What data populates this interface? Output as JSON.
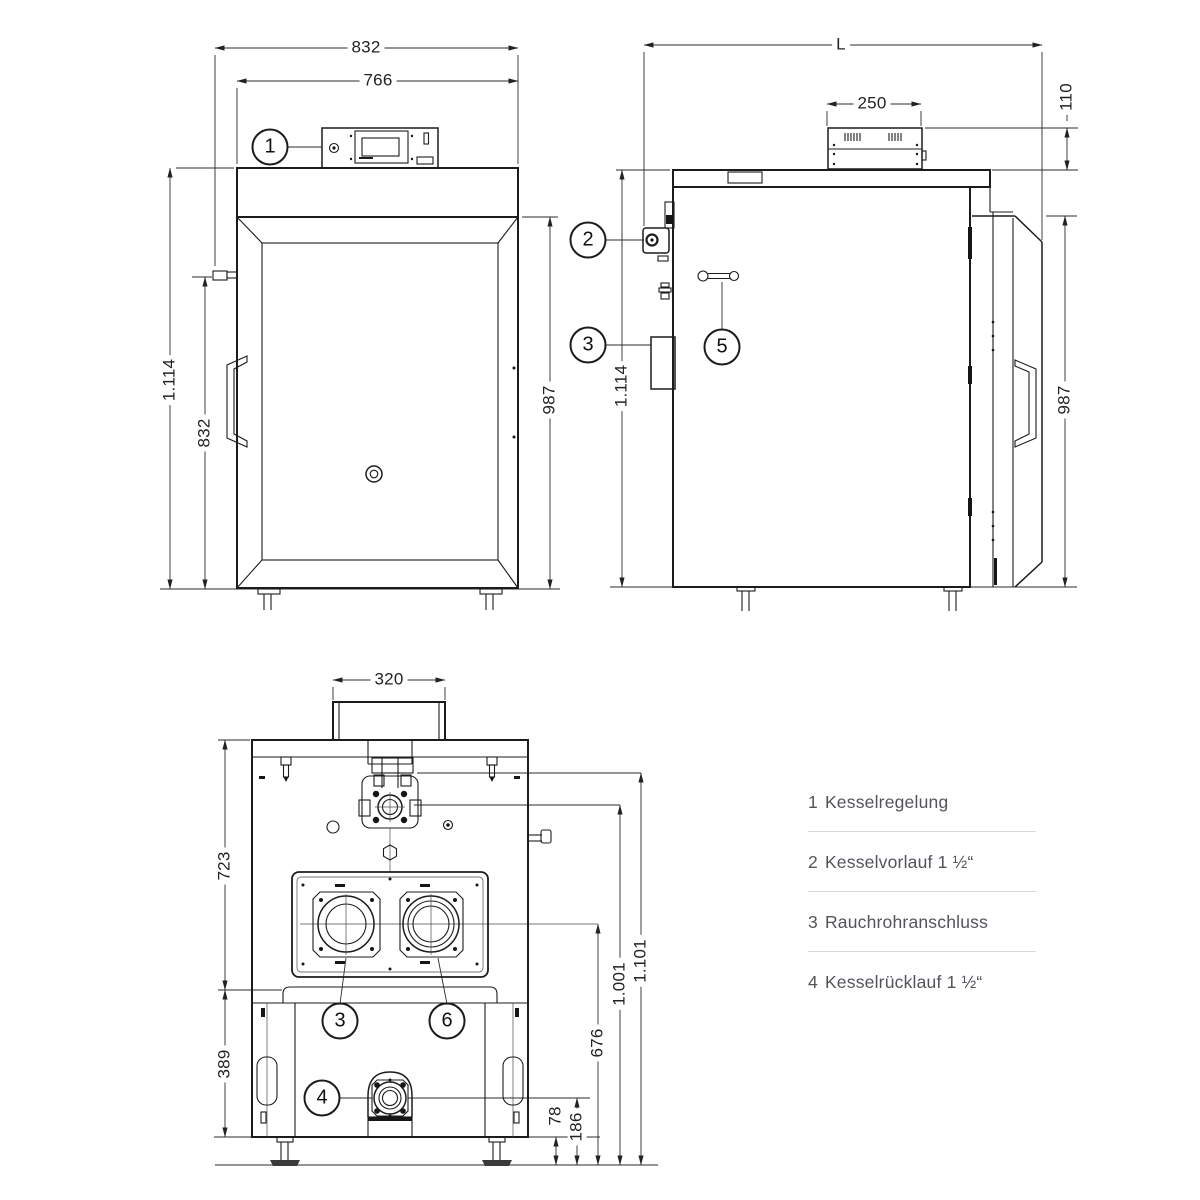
{
  "drawing": {
    "views": {
      "front": {
        "dims": {
          "width_total": "832",
          "width_body": "766",
          "height_total": "1.114",
          "latch_height": "832",
          "door_height": "987"
        }
      },
      "side": {
        "dims": {
          "length": "L",
          "controller_width": "250",
          "controller_height": "110",
          "height_total": "1.114",
          "door_height": "987"
        }
      },
      "rear": {
        "dims": {
          "flue_duct_width": "320",
          "upper_section_height": "723",
          "lower_section_height": "389",
          "bottom_clearance": "78",
          "return_center_height": "186",
          "flue_center_height": "676",
          "flow_center_height": "1.001",
          "body_top_height": "1.101"
        }
      }
    }
  },
  "callouts": {
    "one": "1",
    "two": "2",
    "three": "3",
    "four": "4",
    "five": "5",
    "six": "6"
  },
  "legend": {
    "items": [
      {
        "number": "1",
        "label": "Kesselregelung"
      },
      {
        "number": "2",
        "label": "Kesselvorlauf 1 ½“"
      },
      {
        "number": "3",
        "label": "Rauchrohranschluss"
      },
      {
        "number": "4",
        "label": "Kesselrücklauf 1 ½“"
      }
    ]
  },
  "colors": {
    "ink": "#1c1c1e",
    "legend_text": "#53535b",
    "divider": "#d8d8d8",
    "background": "#ffffff"
  }
}
